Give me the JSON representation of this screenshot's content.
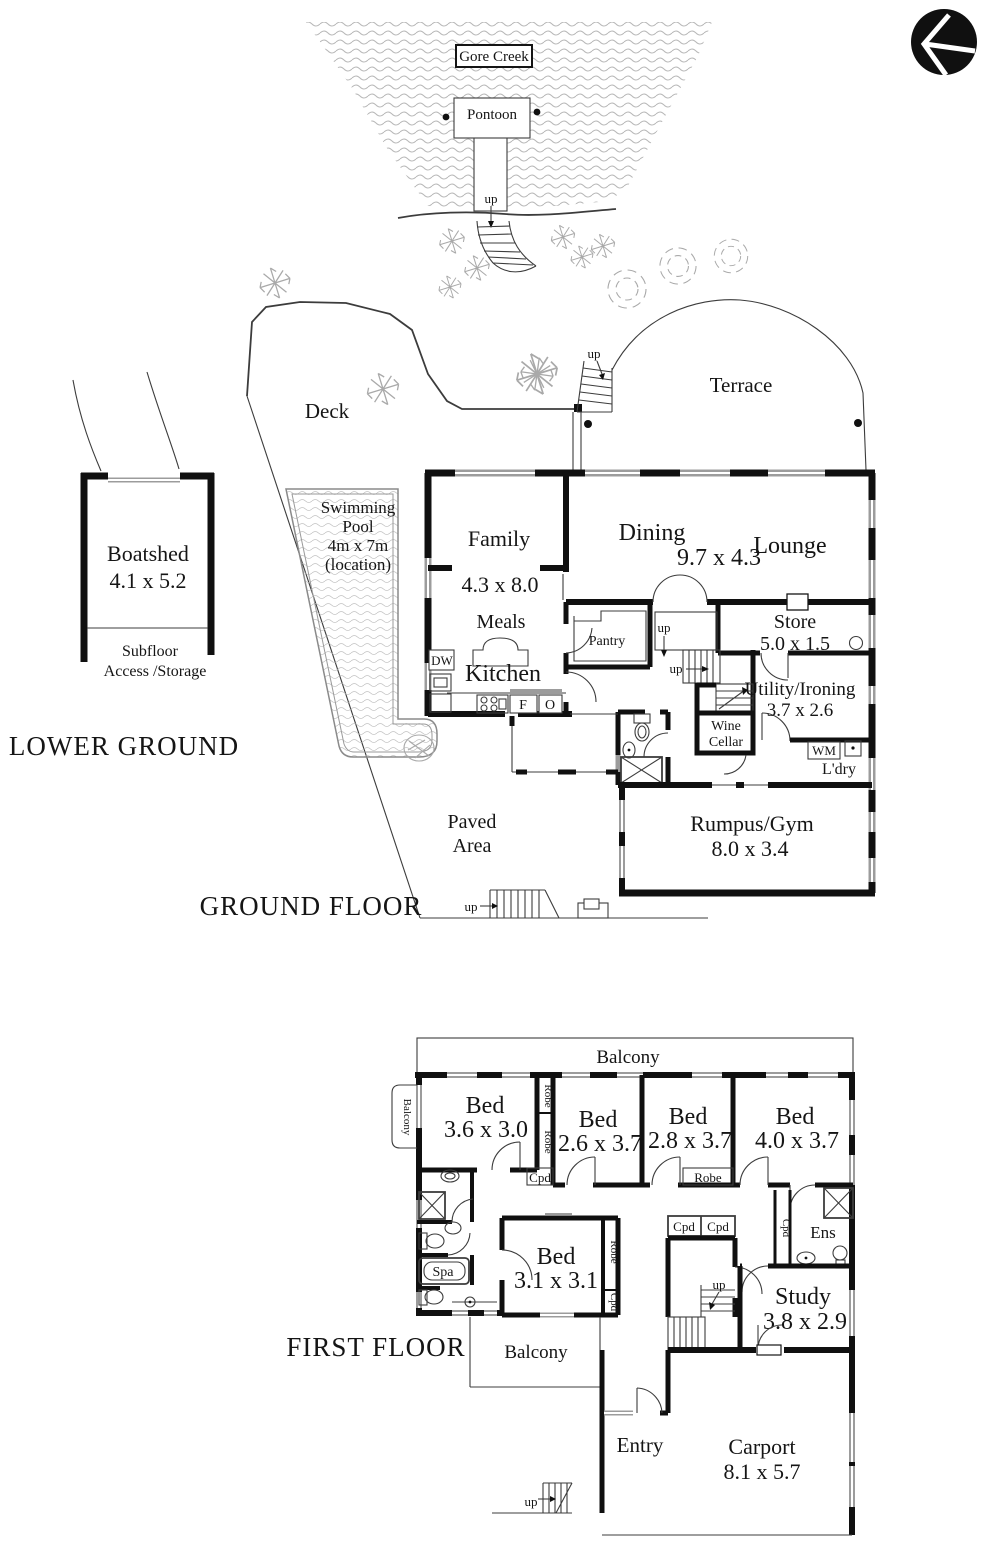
{
  "labels": {
    "up": "up",
    "balcony": "Balcony",
    "bed": "Bed",
    "robe": "Robe",
    "cpd": "Cpd"
  },
  "creek": {
    "name": "Gore Creek",
    "pontoon": "Pontoon"
  },
  "site": {
    "deck": "Deck",
    "terrace": "Terrace",
    "paved_line1": "Paved",
    "paved_line2": "Area",
    "pool_line1": "Swimming",
    "pool_line2": "Pool",
    "pool_line3": "4m x 7m",
    "pool_line4": "(location)"
  },
  "lower_ground": {
    "title": "LOWER GROUND",
    "boatshed": "Boatshed",
    "boatshed_dims": "4.1 x 5.2",
    "subfloor_line1": "Subfloor",
    "subfloor_line2": "Access /Storage"
  },
  "ground_floor": {
    "title": "GROUND FLOOR",
    "family": "Family",
    "family_dims": "4.3 x 8.0",
    "dining": "Dining",
    "dining_dims": "9.7 x 4.3",
    "lounge": "Lounge",
    "meals": "Meals",
    "kitchen": "Kitchen",
    "pantry": "Pantry",
    "dishwasher": "DW",
    "fridge": "F",
    "oven": "O",
    "store": "Store",
    "store_dims": "5.0 x 1.5",
    "utility": "Utility/Ironing",
    "utility_dims": "3.7 x 2.6",
    "wine_line1": "Wine",
    "wine_line2": "Cellar",
    "washing_machine": "WM",
    "laundry": "L'dry",
    "rumpus": "Rumpus/Gym",
    "rumpus_dims": "8.0 x 3.4"
  },
  "first_floor": {
    "title": "FIRST FLOOR",
    "bed1_dims": "3.6 x 3.0",
    "bed2_dims": "2.6 x 3.7",
    "bed3_dims": "2.8 x 3.7",
    "bed4_dims": "4.0 x 3.7",
    "bed5_dims": "3.1 x 3.1",
    "ens": "Ens",
    "spa": "Spa",
    "study": "Study",
    "study_dims": "3.8 x 2.9",
    "entry": "Entry",
    "carport": "Carport",
    "carport_dims": "8.1 x 5.7"
  },
  "colors": {
    "wall": "#101010",
    "window": "#9c9c9c",
    "thin_line": "#3c3c3c",
    "foliage": "#a9a9a9",
    "water_line": "#b8b8b8"
  }
}
